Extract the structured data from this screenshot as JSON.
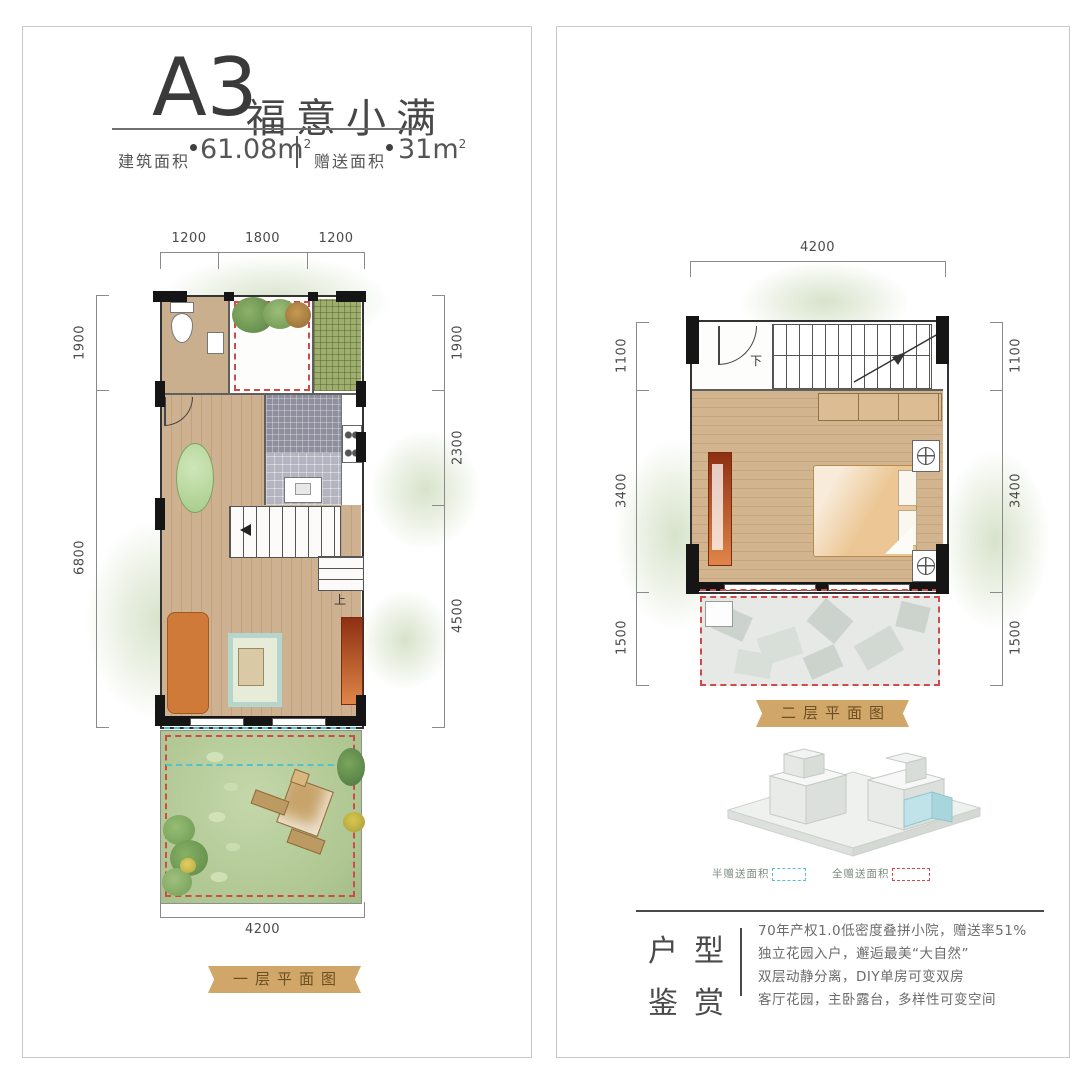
{
  "header": {
    "unit": "A3",
    "name": "福意小满",
    "area1_label": "建筑面积",
    "area1_value": "61.08m",
    "area2_label": "赠送面积",
    "area2_value": "31m",
    "sup": "2"
  },
  "plan1": {
    "banner": "一层平面图",
    "dims_top": [
      "1200",
      "1800",
      "1200"
    ],
    "dims_left": [
      "1900",
      "6800"
    ],
    "dims_right": [
      "1900",
      "2300",
      "4500"
    ],
    "dim_bottom": "4200",
    "stair_label": "上"
  },
  "plan2": {
    "banner": "二层平面图",
    "dim_top": "4200",
    "dims_left": [
      "1100",
      "3400",
      "1500"
    ],
    "dims_right": [
      "1100",
      "3400",
      "1500"
    ],
    "stair_label": "下"
  },
  "legend": {
    "half": "半赠送面积",
    "full": "全赠送面积"
  },
  "appreciation": {
    "title_chars": [
      "户",
      "型",
      "鉴",
      "赏"
    ],
    "lines": [
      "70年产权1.0低密度叠拼小院，赠送率51%",
      "独立花园入户，邂逅最美“大自然”",
      "双层动静分离，DIY单房可变双房",
      "客厅花园，主卧露台，多样性可变空间"
    ]
  },
  "colors": {
    "banner": "#d0a769",
    "red_dash": "#cf4a4a",
    "cyan_dash": "#52c2cb",
    "wood": "#cdb190",
    "lawn": "#b9cfa0"
  }
}
